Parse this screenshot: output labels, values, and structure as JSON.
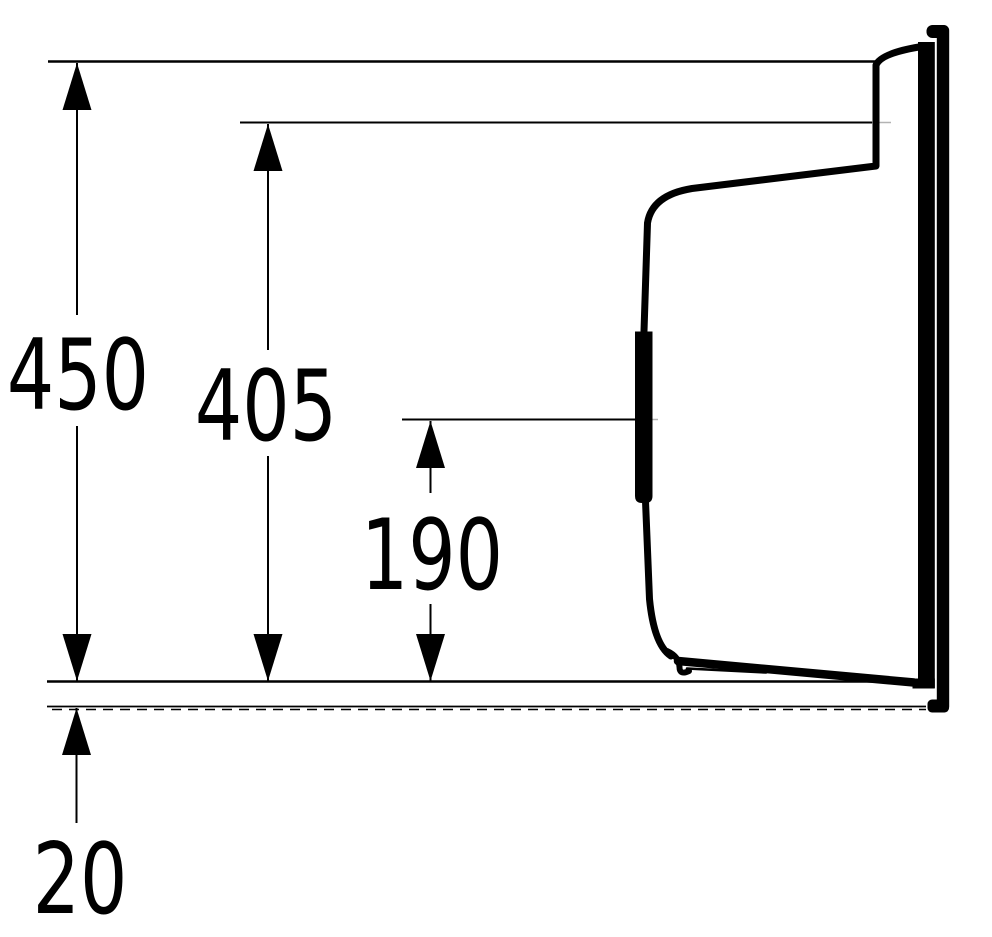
{
  "drawing": {
    "background_color": "#ffffff",
    "line_color": "#000000",
    "faint_line_color": "#b3b3b3",
    "labels": {
      "dim_450": "450",
      "dim_405": "405",
      "dim_190": "190",
      "dim_20": "20"
    },
    "dimensions": [
      {
        "name": "overall-height",
        "label": "450",
        "value": 450,
        "orientation": "vertical"
      },
      {
        "name": "rim-height",
        "label": "405",
        "value": 405,
        "orientation": "vertical"
      },
      {
        "name": "mid-height",
        "label": "190",
        "value": 190,
        "orientation": "vertical"
      },
      {
        "name": "base-offset",
        "label": "20",
        "value": 20,
        "orientation": "vertical"
      }
    ]
  }
}
